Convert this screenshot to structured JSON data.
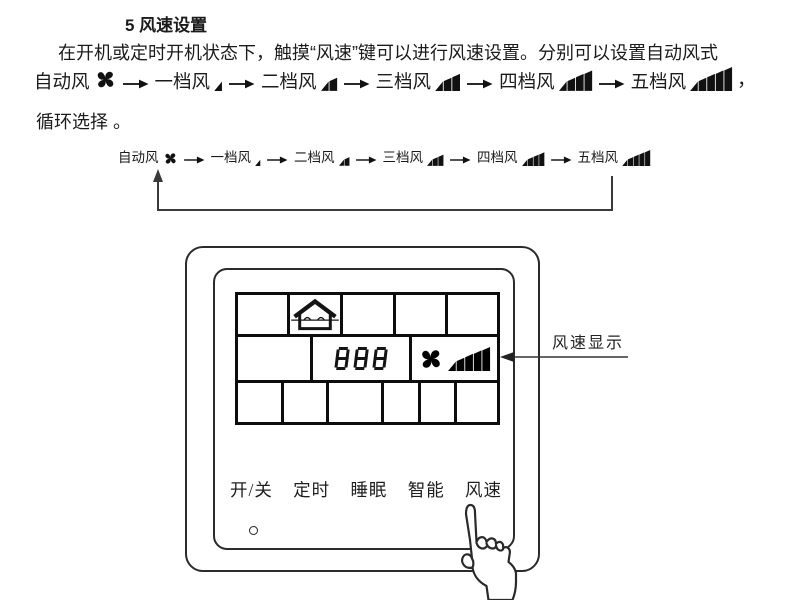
{
  "doc": {
    "title": "5 风速设置",
    "line1": "在开机或定时开机状态下，触摸“风速”键可以进行风速设置。分别可以设置自动风式",
    "line3": "循环选择 。",
    "comma": "，"
  },
  "flow": {
    "items": [
      {
        "name": "auto",
        "label": "自动风",
        "level": 0,
        "icon": "fan-icon"
      },
      {
        "name": "level-1",
        "label": "一档风",
        "level": 1,
        "icon": "wind-bars-1-icon"
      },
      {
        "name": "level-2",
        "label": "二档风",
        "level": 2,
        "icon": "wind-bars-2-icon"
      },
      {
        "name": "level-3",
        "label": "三档风",
        "level": 3,
        "icon": "wind-bars-3-icon"
      },
      {
        "name": "level-4",
        "label": "四档风",
        "level": 4,
        "icon": "wind-bars-4-icon"
      },
      {
        "name": "level-5",
        "label": "五档风",
        "level": 5,
        "icon": "wind-bars-5-icon"
      }
    ],
    "loop_icon": "cycle-back-arrow"
  },
  "panel": {
    "lcd": {
      "value": "888",
      "fan_speed_level": 5,
      "icons": [
        "house-airflow-icon",
        "fan-icon",
        "wind-bars-5-icon"
      ]
    },
    "buttons": [
      {
        "name": "power",
        "label": "开/关"
      },
      {
        "name": "timer",
        "label": "定时"
      },
      {
        "name": "sleep",
        "label": "睡眠"
      },
      {
        "name": "smart",
        "label": "智能"
      },
      {
        "name": "fan-speed",
        "label": "风速"
      }
    ],
    "callout": {
      "label": "风速显示"
    }
  }
}
